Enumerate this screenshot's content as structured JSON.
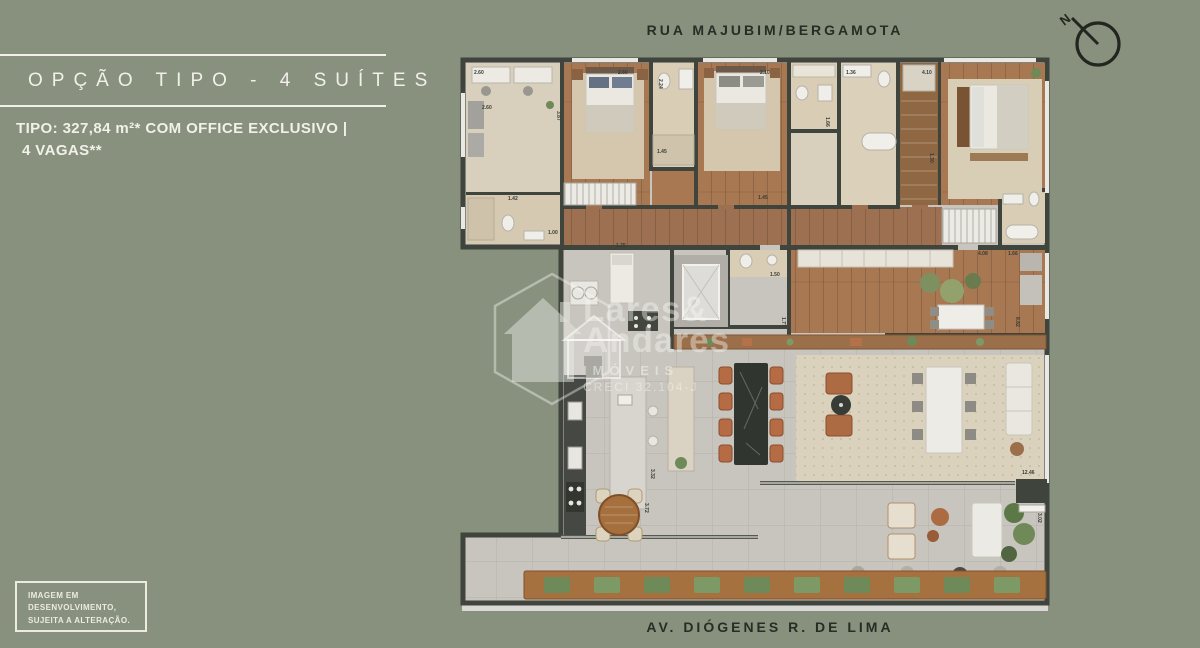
{
  "header": {
    "title": "OPÇÃO TIPO - 4 SUÍTES",
    "subtitle_line1": "TIPO: 327,84 m²* COM OFFICE EXCLUSIVO |",
    "subtitle_line2": "4 VAGAS**"
  },
  "streets": {
    "top": "RUA MAJUBIM/BERGAMOTA",
    "bottom": "AV. DIÓGENES R. DE LIMA"
  },
  "compass": {
    "label": "N"
  },
  "disclaimer": {
    "line1": "IMAGEM EM",
    "line2": "DESENVOLVIMENTO,",
    "line3": "SUJEITA A ALTERAÇÃO."
  },
  "watermark": {
    "line1": "Lares&",
    "line2": "Andares",
    "line3": "IMÓVEIS",
    "line4": "CRECI 32.104-J"
  },
  "colors": {
    "background": "#87917e",
    "text_light": "#f1f0e9",
    "text_dark": "#272d25",
    "wall": "#3f443c",
    "wood_floor": "#a87853",
    "tile_floor": "#c8c4be",
    "rug": "#dbd2bd",
    "chair_terracotta": "#b56c44",
    "plant_green": "#6d8a58",
    "counter_dark": "#454843"
  },
  "floorplan": {
    "dimensions": [
      {
        "t": "2.60",
        "x": 14,
        "y": 17
      },
      {
        "t": "2.60",
        "x": 158,
        "y": 17
      },
      {
        "t": "2.24",
        "x": 199,
        "y": 22,
        "r": 90
      },
      {
        "t": "2.10",
        "x": 300,
        "y": 17
      },
      {
        "t": "1.36",
        "x": 386,
        "y": 17
      },
      {
        "t": "4.10",
        "x": 462,
        "y": 17
      },
      {
        "t": "2.60",
        "x": 22,
        "y": 52
      },
      {
        "t": "3.87",
        "x": 97,
        "y": 54,
        "r": 90
      },
      {
        "t": "1.42",
        "x": 48,
        "y": 143
      },
      {
        "t": "1.45",
        "x": 197,
        "y": 96
      },
      {
        "t": "1.00",
        "x": 88,
        "y": 177
      },
      {
        "t": "1.75",
        "x": 156,
        "y": 190
      },
      {
        "t": "1.30",
        "x": 470,
        "y": 96,
        "r": 90
      },
      {
        "t": "1.66",
        "x": 366,
        "y": 60,
        "r": 90
      },
      {
        "t": "1.45",
        "x": 298,
        "y": 142
      },
      {
        "t": "1.50",
        "x": 310,
        "y": 219
      },
      {
        "t": "1.77",
        "x": 322,
        "y": 260,
        "r": 90
      },
      {
        "t": "4.08",
        "x": 518,
        "y": 198
      },
      {
        "t": "1.66",
        "x": 548,
        "y": 198
      },
      {
        "t": "8.82",
        "x": 556,
        "y": 260,
        "r": 90
      },
      {
        "t": "3.32",
        "x": 191,
        "y": 412,
        "r": 90
      },
      {
        "t": "3.72",
        "x": 185,
        "y": 446,
        "r": 90
      },
      {
        "t": "12.46",
        "x": 562,
        "y": 417
      },
      {
        "t": "3.02",
        "x": 578,
        "y": 456,
        "r": 90
      }
    ],
    "planter": {
      "count": 10,
      "x0": 84,
      "step": 50,
      "y": 520,
      "w": 26,
      "h": 16,
      "color": "#6d8a58",
      "color_alt": "#7d9a66"
    },
    "dining": {
      "left_x": 259,
      "right_x": 310,
      "chair_ys": [
        310,
        336,
        362,
        388
      ],
      "w": 13,
      "h": 17,
      "color": "#b56c44",
      "stroke": "#8a4e2e"
    }
  }
}
